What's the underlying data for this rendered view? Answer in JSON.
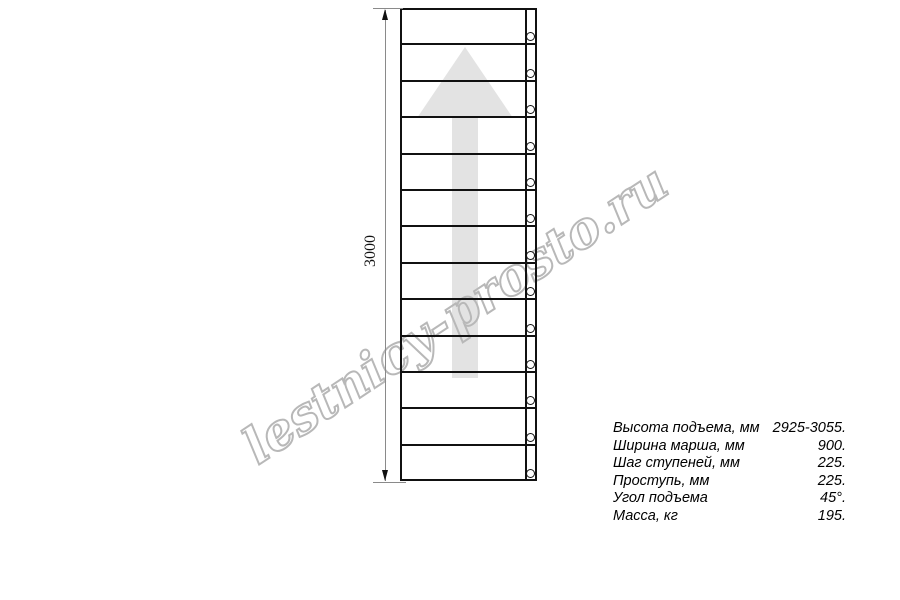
{
  "diagram": {
    "dimension_label": "3000",
    "watermark": "lestnicy-prosto.ru",
    "arrow_direction": "up",
    "stairs": {
      "treads": 13,
      "holes": 13
    },
    "colors": {
      "line": "#111111",
      "arrow": "#e3e3e3",
      "watermark": "#b8b8b8",
      "dimension": "#8a8a8a"
    }
  },
  "specs": {
    "rows": [
      {
        "label": "Высота подъема, мм",
        "value": "2925-3055."
      },
      {
        "label": "Ширина марша, мм",
        "value": "900."
      },
      {
        "label": "Шаг ступеней, мм",
        "value": "225."
      },
      {
        "label": "Проступь, мм",
        "value": "225."
      },
      {
        "label": "Угол подъема",
        "value": "45°."
      },
      {
        "label": "Масса, кг",
        "value": "195."
      }
    ]
  }
}
